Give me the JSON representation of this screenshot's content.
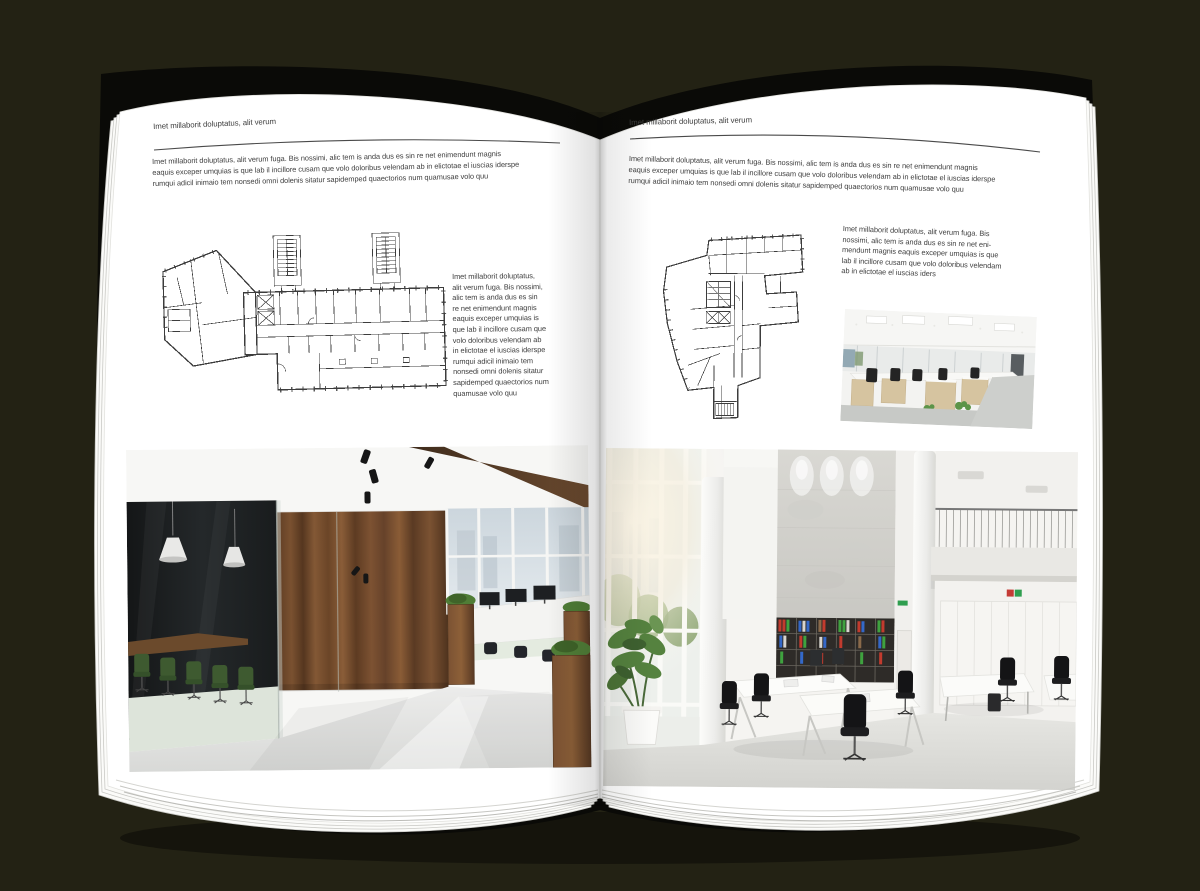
{
  "colors": {
    "background": "#232214",
    "cover": "#0a0a07",
    "page": "#ffffff",
    "text": "#3d3d3d",
    "rule": "#4a4a4a"
  },
  "left_page": {
    "header": "Imet millaborit doluptatus, alit verum",
    "intro": "Imet millaborit doluptatus, alit verum fuga. Bis nossimi, alic tem is anda dus es sin re net enimendunt magnis\neaquis exceper umquias is que lab il incillore cusam que volo doloribus velendam ab in elictotae el iuscias iderspe\nrumqui adicil inimaio tem nonsedi omni dolenis sitatur sapidemped quaectorios num quamusae volo quu",
    "caption": "Imet millaborit doluptatus,\nalit verum fuga. Bis nossimi,\nalic tem is anda dus es sin\nre net enimendunt magnis\neaquis exceper umquias is\nque lab il incillore cusam que\nvolo doloribus velendam ab\nin elictotae el iuscias iderspe\nrumqui adicil inimaio tem\nnonsedi omni dolenis sitatur\nsapidemped quaectorios num\nquamusae volo quu"
  },
  "right_page": {
    "header": "Imet millaborit doluptatus, alit verum",
    "intro": "Imet millaborit doluptatus, alit verum fuga. Bis nossimi, alic tem is anda dus es sin re net enimendunt magnis\neaquis exceper umquias is que lab il incillore cusam que volo doloribus velendam ab in elictotae el iuscias iderspe\nrumqui adicil inimaio tem nonsedi omni dolenis sitatur sapidemped quaectorios num quamusae volo quu",
    "caption": "Imet millaborit doluptatus, alit verum fuga. Bis\nnossimi, alic tem is anda dus es sin re net eni-\nmendunt magnis eaquis exceper umquias is que\nlab il incillore cusam que volo doloribus velendam\nab in elictotae el iuscias iders"
  }
}
